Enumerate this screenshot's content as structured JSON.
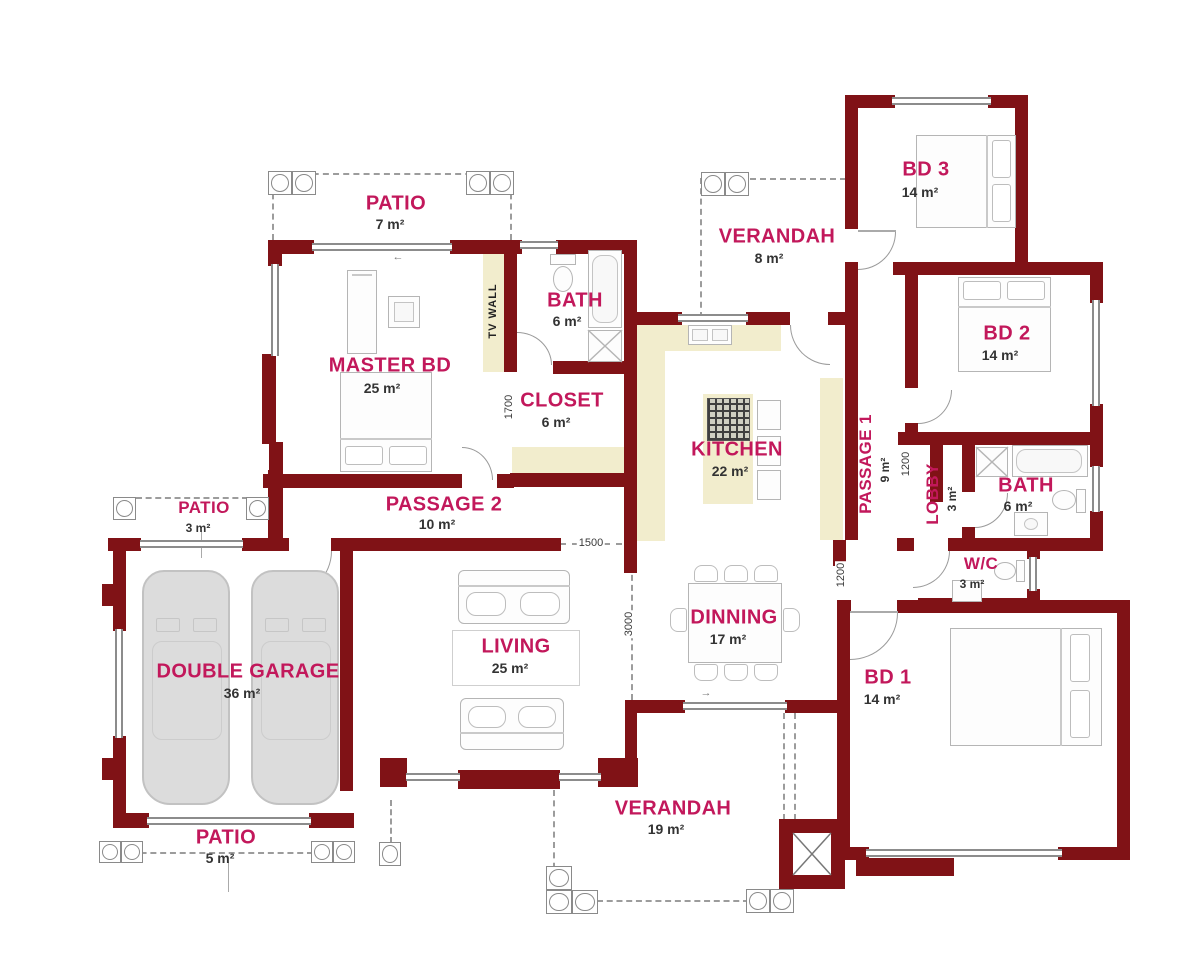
{
  "rooms": [
    {
      "id": "patio-top",
      "name": "PATIO",
      "area": "7 m²"
    },
    {
      "id": "master-bd",
      "name": "MASTER BD",
      "area": "25 m²"
    },
    {
      "id": "bath-master",
      "name": "BATH",
      "area": "6 m²"
    },
    {
      "id": "closet",
      "name": "CLOSET",
      "area": "6 m²"
    },
    {
      "id": "verandah-top",
      "name": "VERANDAH",
      "area": "8 m²"
    },
    {
      "id": "bd3",
      "name": "BD 3",
      "area": "14 m²"
    },
    {
      "id": "bd2",
      "name": "BD 2",
      "area": "14 m²"
    },
    {
      "id": "kitchen",
      "name": "KITCHEN",
      "area": "22 m²"
    },
    {
      "id": "passage1",
      "name": "PASSAGE 1",
      "area": "9 m²"
    },
    {
      "id": "lobby",
      "name": "LOBBY",
      "area": "3 m²"
    },
    {
      "id": "bath2",
      "name": "BATH",
      "area": "6 m²"
    },
    {
      "id": "wc",
      "name": "W/C",
      "area": "3 m²"
    },
    {
      "id": "passage2",
      "name": "PASSAGE 2",
      "area": "10 m²"
    },
    {
      "id": "patio-left",
      "name": "PATIO",
      "area": "3 m²"
    },
    {
      "id": "garage",
      "name": "DOUBLE GARAGE",
      "area": "36 m²"
    },
    {
      "id": "living",
      "name": "LIVING",
      "area": "25 m²"
    },
    {
      "id": "dinning",
      "name": "DINNING",
      "area": "17 m²"
    },
    {
      "id": "bd1",
      "name": "BD 1",
      "area": "14 m²"
    },
    {
      "id": "verandah-bottom",
      "name": "VERANDAH",
      "area": "19 m²"
    },
    {
      "id": "patio-bottom",
      "name": "PATIO",
      "area": "5 m²"
    }
  ],
  "labels": {
    "tv_wall": "TV WALL"
  },
  "dims": [
    "1700",
    "1500",
    "3000",
    "1200",
    "1200"
  ],
  "glyphs": {
    "arrow_left": "←",
    "arrow_right": "→"
  },
  "colors": {
    "wall": "#801216",
    "room_label": "#c2185b",
    "counter": "#f2edcd",
    "area_text": "#333333"
  }
}
